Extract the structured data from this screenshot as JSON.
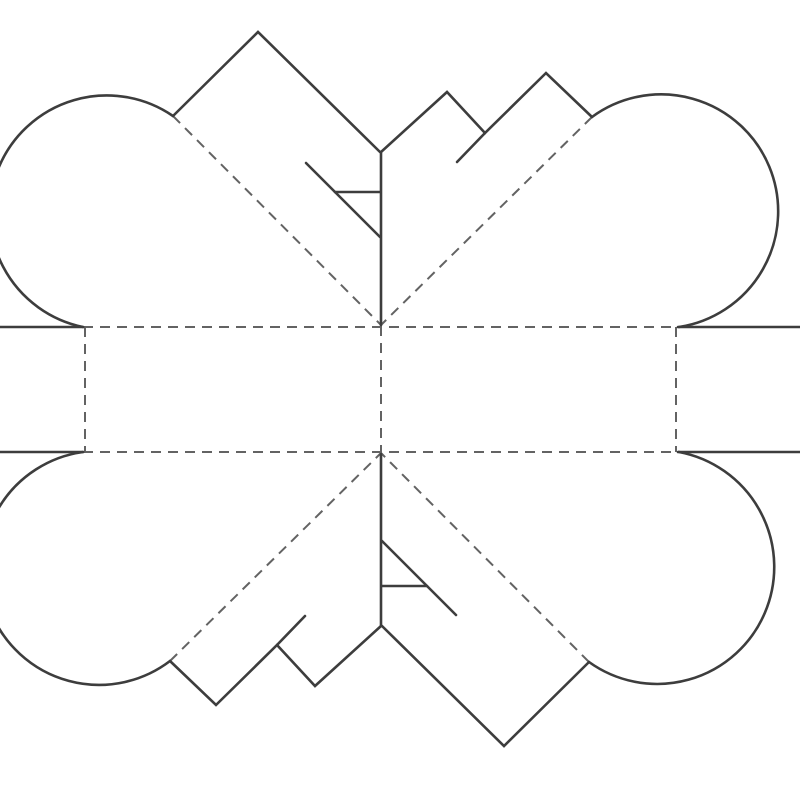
{
  "page": {
    "background_color": "#ffffff",
    "width": 800,
    "height": 800
  },
  "diagram": {
    "kind": "pop-up-heart-card-template",
    "canvas": {
      "width": 800,
      "height": 800
    },
    "style": {
      "cut_color": "#3d3d3d",
      "cut_width": 2.6,
      "fold_color": "#636363",
      "fold_width": 2,
      "fold_dash": "10 7"
    },
    "cut_polylines": [
      {
        "name": "left-edge-top-horizontal",
        "points": [
          [
            0,
            327
          ],
          [
            83,
            327
          ]
        ]
      },
      {
        "name": "top-left-diamond-edges",
        "points": [
          [
            173,
            116
          ],
          [
            258,
            32
          ],
          [
            380,
            152
          ]
        ]
      },
      {
        "name": "center-top-vertical",
        "points": [
          [
            381,
            152
          ],
          [
            381,
            325
          ]
        ]
      },
      {
        "name": "top-right-zigzag",
        "points": [
          [
            381,
            152
          ],
          [
            447,
            92
          ],
          [
            485,
            133
          ],
          [
            546,
            73
          ],
          [
            592,
            117
          ]
        ]
      },
      {
        "name": "top-right-slit",
        "points": [
          [
            485,
            133
          ],
          [
            457,
            162
          ]
        ]
      },
      {
        "name": "top-stair-diagonal",
        "points": [
          [
            306,
            163
          ],
          [
            380,
            237
          ]
        ]
      },
      {
        "name": "top-stair-tick",
        "points": [
          [
            335,
            192
          ],
          [
            380,
            192
          ]
        ]
      },
      {
        "name": "right-edge-top-horizontal",
        "points": [
          [
            678,
            327
          ],
          [
            800,
            327
          ]
        ]
      },
      {
        "name": "right-edge-bottom-horizontal",
        "points": [
          [
            678,
            452
          ],
          [
            800,
            452
          ]
        ]
      },
      {
        "name": "bottom-right-diamond-edges",
        "points": [
          [
            589,
            662
          ],
          [
            504,
            746
          ],
          [
            382,
            626
          ]
        ]
      },
      {
        "name": "center-bottom-vertical",
        "points": [
          [
            381,
            454
          ],
          [
            381,
            626
          ]
        ]
      },
      {
        "name": "bottom-left-zigzag",
        "points": [
          [
            381,
            626
          ],
          [
            315,
            686
          ],
          [
            277,
            645
          ],
          [
            216,
            705
          ],
          [
            170,
            661
          ]
        ]
      },
      {
        "name": "bottom-left-slit",
        "points": [
          [
            277,
            645
          ],
          [
            305,
            616
          ]
        ]
      },
      {
        "name": "bottom-stair-diagonal",
        "points": [
          [
            456,
            615
          ],
          [
            382,
            541
          ]
        ]
      },
      {
        "name": "bottom-stair-tick",
        "points": [
          [
            427,
            586
          ],
          [
            382,
            586
          ]
        ]
      },
      {
        "name": "left-edge-bottom-horizontal",
        "points": [
          [
            0,
            452
          ],
          [
            83,
            452
          ]
        ]
      }
    ],
    "cut_arcs": [
      {
        "name": "top-left-lobe-arc",
        "from": [
          173,
          116
        ],
        "to": [
          83,
          327
        ],
        "radius": 117,
        "large_arc": 1,
        "sweep": 0
      },
      {
        "name": "top-right-lobe-arc",
        "from": [
          592,
          117
        ],
        "to": [
          679,
          327
        ],
        "radius": 117,
        "large_arc": 1,
        "sweep": 1
      },
      {
        "name": "bottom-right-lobe-arc",
        "from": [
          589,
          662
        ],
        "to": [
          679,
          452
        ],
        "radius": 117,
        "large_arc": 1,
        "sweep": 0
      },
      {
        "name": "bottom-left-lobe-arc",
        "from": [
          170,
          661
        ],
        "to": [
          83,
          452
        ],
        "radius": 117,
        "large_arc": 1,
        "sweep": 1
      }
    ],
    "fold_lines": [
      {
        "name": "fold-horizontal-upper",
        "from": [
          83,
          327
        ],
        "to": [
          678,
          327
        ]
      },
      {
        "name": "fold-horizontal-lower",
        "from": [
          83,
          452
        ],
        "to": [
          678,
          452
        ]
      },
      {
        "name": "fold-vertical-left",
        "from": [
          85,
          327
        ],
        "to": [
          85,
          452
        ]
      },
      {
        "name": "fold-vertical-right",
        "from": [
          676,
          327
        ],
        "to": [
          676,
          452
        ]
      },
      {
        "name": "fold-vertical-center",
        "from": [
          381,
          326
        ],
        "to": [
          381,
          452
        ]
      },
      {
        "name": "fold-diagonal-upper-left",
        "from": [
          173,
          116
        ],
        "to": [
          381,
          325
        ]
      },
      {
        "name": "fold-diagonal-upper-right",
        "from": [
          592,
          117
        ],
        "to": [
          381,
          325
        ]
      },
      {
        "name": "fold-diagonal-lower-left",
        "from": [
          170,
          661
        ],
        "to": [
          381,
          453
        ]
      },
      {
        "name": "fold-diagonal-lower-right",
        "from": [
          589,
          662
        ],
        "to": [
          381,
          453
        ]
      }
    ]
  }
}
